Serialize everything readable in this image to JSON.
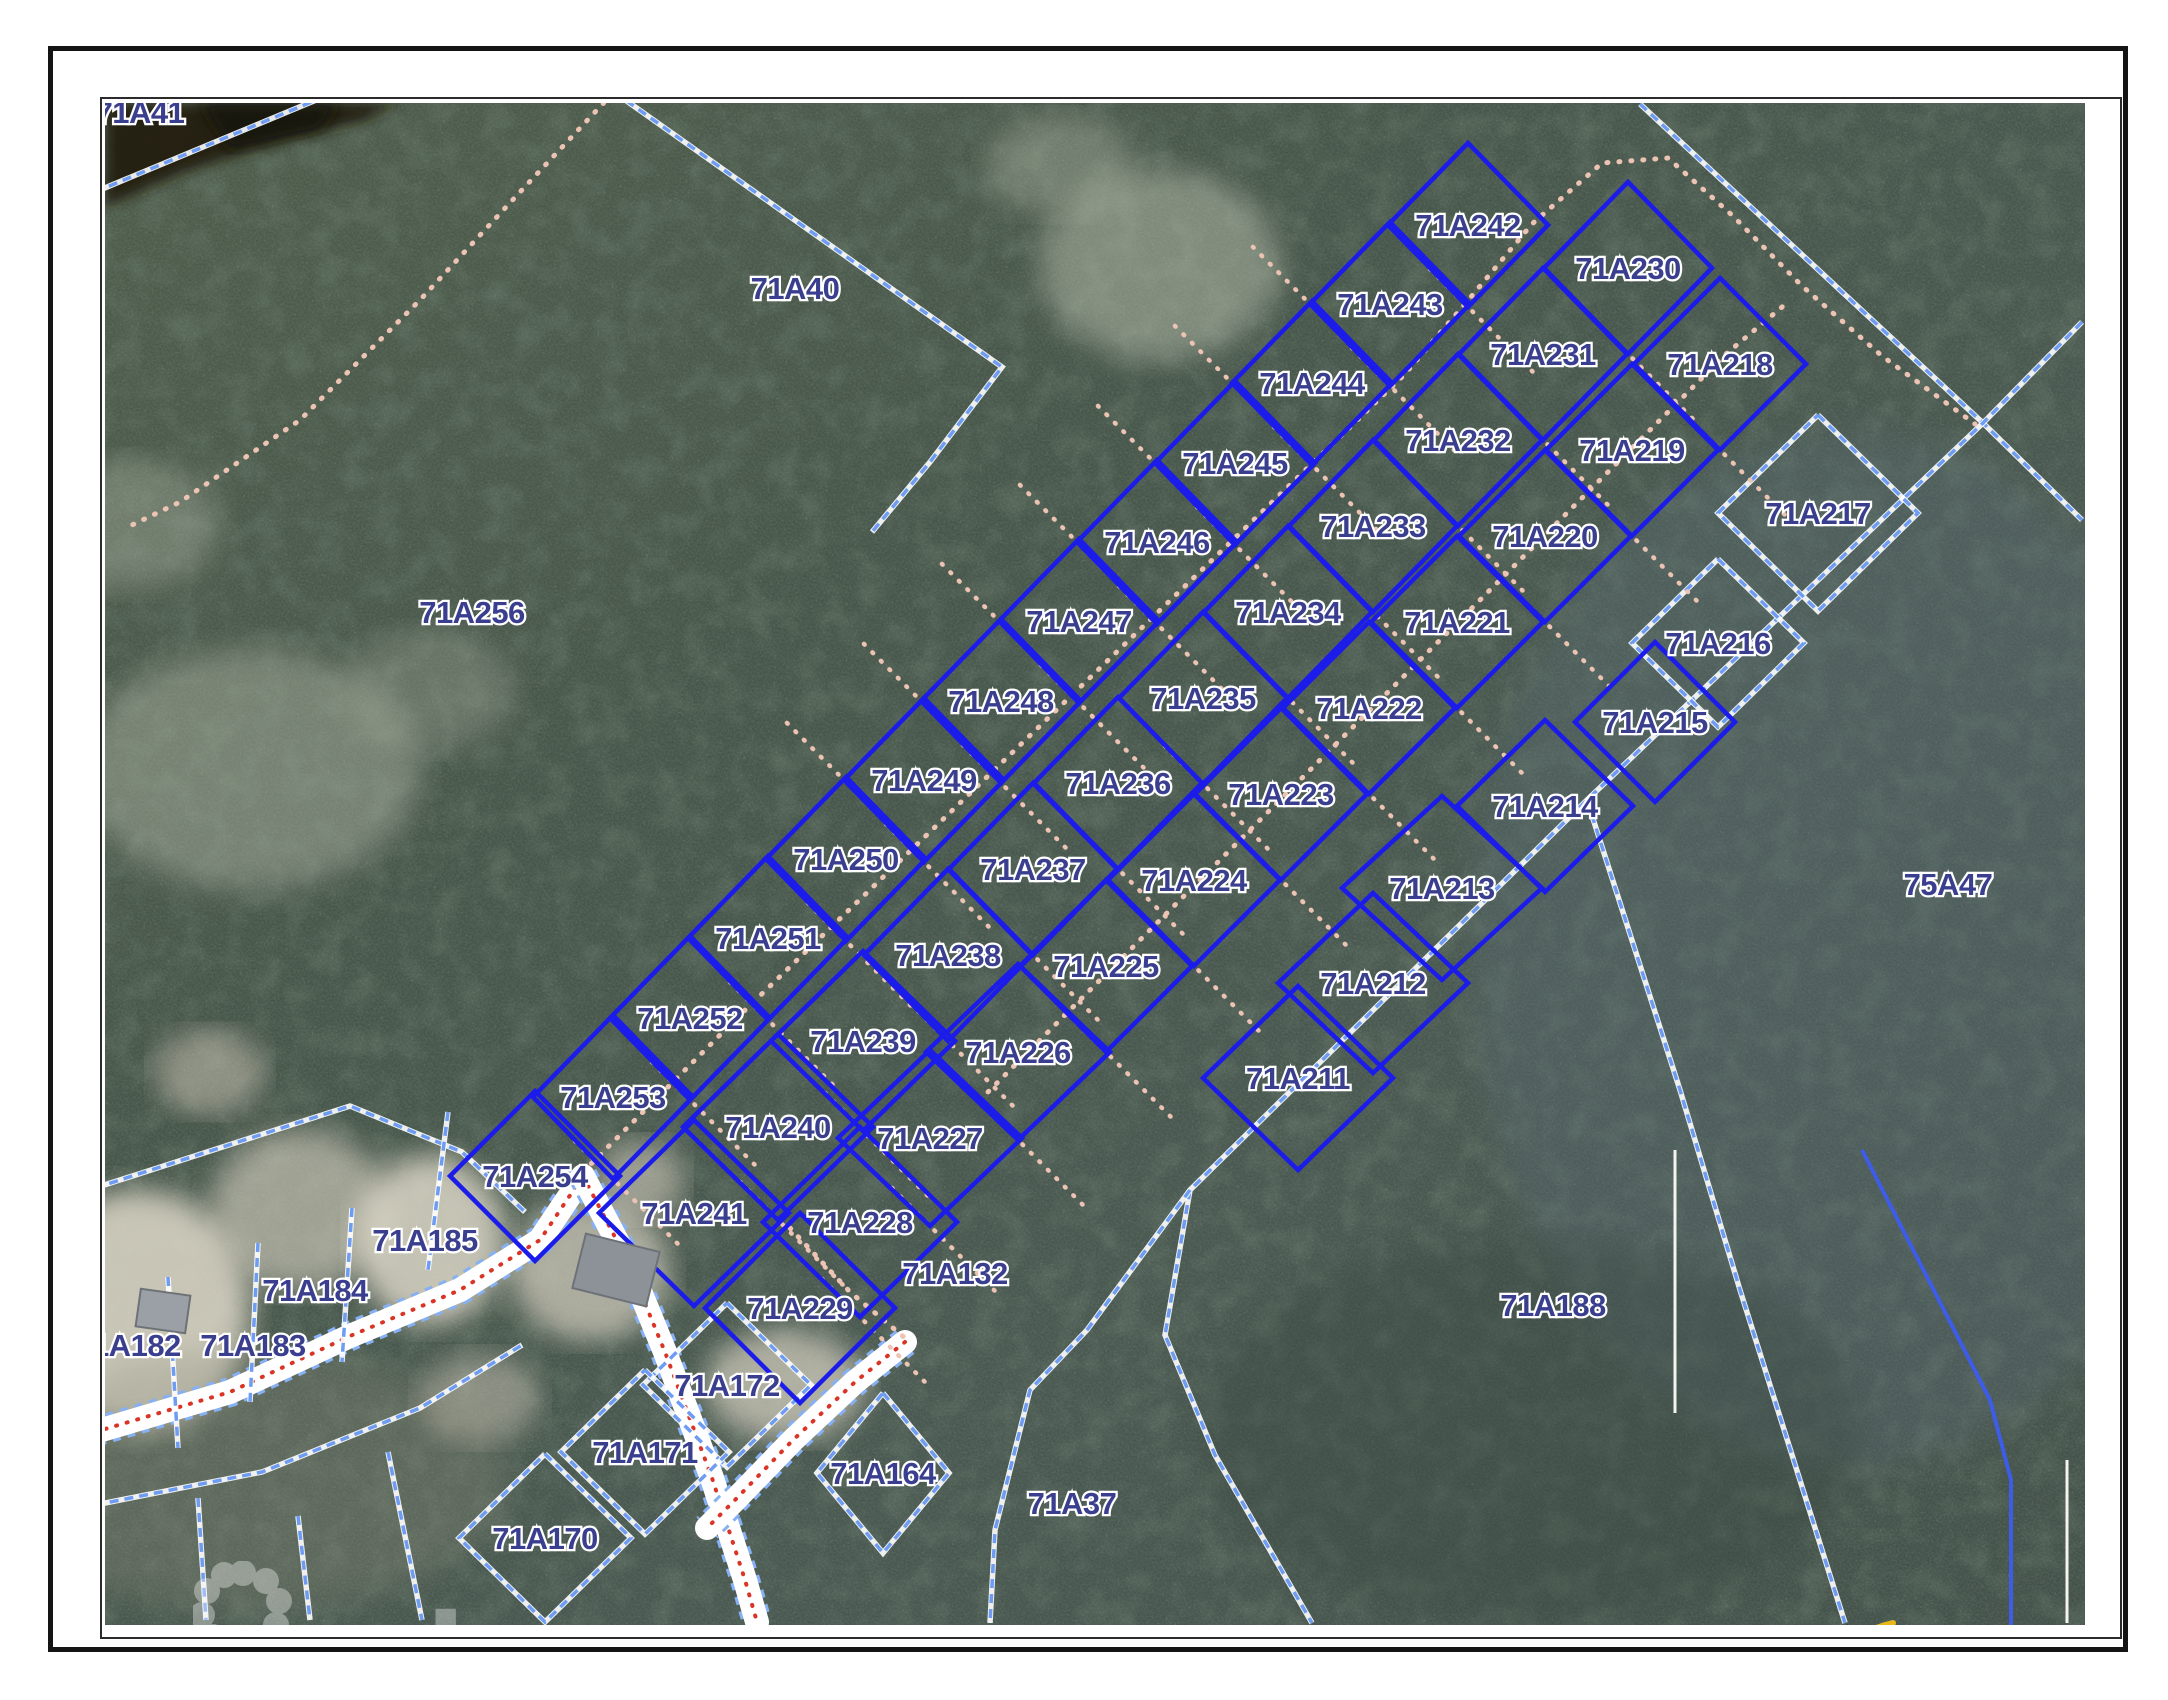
{
  "map": {
    "timestamp": "3/26/26 12:24 PM",
    "watermark_text": "ereba",
    "logo": {
      "title": "CAYMAN LAND INFO",
      "url": "www.caymanlandinfo.ky"
    },
    "colors": {
      "parcel_solid": "#1c1cea",
      "parcel_dashed": "#6d9cf2",
      "parcel_dashed_casing": "#ffffff",
      "boundary_solid_light": "#3d5cе8",
      "label_fill": "#3a3e8e",
      "label_halo": "#ffffff",
      "track_pink": "#edc4b4",
      "road_fill": "#ffffff",
      "road_center_red": "#d93425",
      "water_dark": "#241d10",
      "forest_base": "#49584a"
    },
    "solid_parcels": [
      {
        "id": "71A242",
        "x": 1468,
        "y": 225,
        "w": 80,
        "h": 82,
        "col": "A"
      },
      {
        "id": "71A243",
        "x": 1390,
        "y": 304,
        "w": 80,
        "h": 82,
        "col": "A"
      },
      {
        "id": "71A244",
        "x": 1312,
        "y": 383,
        "w": 80,
        "h": 82,
        "col": "A"
      },
      {
        "id": "71A245",
        "x": 1235,
        "y": 463,
        "w": 80,
        "h": 82,
        "col": "A"
      },
      {
        "id": "71A246",
        "x": 1157,
        "y": 542,
        "w": 80,
        "h": 82,
        "col": "A"
      },
      {
        "id": "71A247",
        "x": 1079,
        "y": 621,
        "w": 80,
        "h": 82,
        "col": "A"
      },
      {
        "id": "71A248",
        "x": 1001,
        "y": 701,
        "w": 80,
        "h": 82,
        "col": "A"
      },
      {
        "id": "71A249",
        "x": 924,
        "y": 780,
        "w": 80,
        "h": 82,
        "col": "A"
      },
      {
        "id": "71A250",
        "x": 846,
        "y": 859,
        "w": 80,
        "h": 82,
        "col": "A"
      },
      {
        "id": "71A251",
        "x": 768,
        "y": 938,
        "w": 80,
        "h": 82,
        "col": "A"
      },
      {
        "id": "71A252",
        "x": 690,
        "y": 1018,
        "w": 80,
        "h": 82,
        "col": "A"
      },
      {
        "id": "71A253",
        "x": 613,
        "y": 1097,
        "w": 80,
        "h": 82,
        "col": "A"
      },
      {
        "id": "71A254",
        "x": 535,
        "y": 1176,
        "w": 85,
        "h": 85,
        "col": "A"
      },
      {
        "id": "71A230",
        "x": 1628,
        "y": 268,
        "w": 84,
        "h": 86,
        "col": "B"
      },
      {
        "id": "71A231",
        "x": 1543,
        "y": 354,
        "w": 84,
        "h": 86,
        "col": "B"
      },
      {
        "id": "71A232",
        "x": 1458,
        "y": 440,
        "w": 84,
        "h": 86,
        "col": "B"
      },
      {
        "id": "71A233",
        "x": 1373,
        "y": 526,
        "w": 84,
        "h": 86,
        "col": "B"
      },
      {
        "id": "71A234",
        "x": 1288,
        "y": 612,
        "w": 84,
        "h": 86,
        "col": "B"
      },
      {
        "id": "71A235",
        "x": 1203,
        "y": 698,
        "w": 84,
        "h": 86,
        "col": "B"
      },
      {
        "id": "71A236",
        "x": 1118,
        "y": 783,
        "w": 84,
        "h": 86,
        "col": "B"
      },
      {
        "id": "71A237",
        "x": 1033,
        "y": 869,
        "w": 84,
        "h": 86,
        "col": "B"
      },
      {
        "id": "71A238",
        "x": 948,
        "y": 955,
        "w": 84,
        "h": 86,
        "col": "B"
      },
      {
        "id": "71A239",
        "x": 863,
        "y": 1041,
        "w": 92,
        "h": 90,
        "col": "B"
      },
      {
        "id": "71A240",
        "x": 778,
        "y": 1127,
        "w": 95,
        "h": 93,
        "col": "B"
      },
      {
        "id": "71A241",
        "x": 694,
        "y": 1213,
        "w": 95,
        "h": 93,
        "col": "B"
      },
      {
        "id": "71A218",
        "x": 1720,
        "y": 364,
        "w": 86,
        "h": 86,
        "col": "C"
      },
      {
        "id": "71A219",
        "x": 1632,
        "y": 450,
        "w": 86,
        "h": 86,
        "col": "C"
      },
      {
        "id": "71A220",
        "x": 1545,
        "y": 536,
        "w": 86,
        "h": 86,
        "col": "C"
      },
      {
        "id": "71A221",
        "x": 1457,
        "y": 622,
        "w": 86,
        "h": 86,
        "col": "C"
      },
      {
        "id": "71A222",
        "x": 1369,
        "y": 708,
        "w": 86,
        "h": 86,
        "col": "C"
      },
      {
        "id": "71A223",
        "x": 1281,
        "y": 794,
        "w": 86,
        "h": 86,
        "col": "C"
      },
      {
        "id": "71A224",
        "x": 1194,
        "y": 880,
        "w": 86,
        "h": 86,
        "col": "C"
      },
      {
        "id": "71A225",
        "x": 1106,
        "y": 966,
        "w": 86,
        "h": 86,
        "col": "C"
      },
      {
        "id": "71A226",
        "x": 1018,
        "y": 1052,
        "w": 92,
        "h": 88,
        "col": "C"
      },
      {
        "id": "71A227",
        "x": 930,
        "y": 1138,
        "w": 92,
        "h": 88,
        "col": "C"
      },
      {
        "id": "71A228",
        "x": 860,
        "y": 1222,
        "w": 97,
        "h": 95,
        "col": "C"
      },
      {
        "id": "71A229",
        "x": 800,
        "y": 1308,
        "w": 95,
        "h": 95,
        "col": "C"
      },
      {
        "id": "71A215",
        "x": 1655,
        "y": 722,
        "w": 80,
        "h": 80,
        "col": "D"
      },
      {
        "id": "71A214",
        "x": 1545,
        "y": 806,
        "w": 88,
        "h": 86,
        "col": "D"
      },
      {
        "id": "71A213",
        "x": 1442,
        "y": 888,
        "w": 100,
        "h": 92,
        "col": "D"
      },
      {
        "id": "71A212",
        "x": 1373,
        "y": 983,
        "w": 95,
        "h": 90,
        "col": "D"
      },
      {
        "id": "71A211",
        "x": 1298,
        "y": 1078,
        "w": 95,
        "h": 92,
        "col": "D"
      }
    ],
    "dashed_parcels": [
      {
        "id": "71A217",
        "x": 1818,
        "y": 513,
        "w": 100,
        "h": 98
      },
      {
        "id": "71A216",
        "x": 1718,
        "y": 643,
        "w": 86,
        "h": 84
      },
      {
        "id": "71A164",
        "x": 883,
        "y": 1473,
        "w": 66,
        "h": 80
      },
      {
        "id": "71A172",
        "x": 727,
        "y": 1385,
        "w": 84,
        "h": 82
      },
      {
        "id": "71A171",
        "x": 645,
        "y": 1452,
        "w": 84,
        "h": 82
      },
      {
        "id": "71A170",
        "x": 545,
        "y": 1538,
        "w": 86,
        "h": 84
      }
    ],
    "area_labels": [
      {
        "id": "71A41",
        "x": 140,
        "y": 112
      },
      {
        "id": "71A40",
        "x": 795,
        "y": 288
      },
      {
        "id": "71A256",
        "x": 472,
        "y": 612
      },
      {
        "id": "75A47",
        "x": 1948,
        "y": 884
      },
      {
        "id": "71A132",
        "x": 955,
        "y": 1273
      },
      {
        "id": "71A37",
        "x": 1072,
        "y": 1503
      },
      {
        "id": "71A188",
        "x": 1553,
        "y": 1305
      },
      {
        "id": "71A185",
        "x": 425,
        "y": 1240
      },
      {
        "id": "71A184",
        "x": 315,
        "y": 1290
      },
      {
        "id": "71A183",
        "x": 253,
        "y": 1345
      },
      {
        "id": "71A182",
        "x": 128,
        "y": 1345
      }
    ],
    "dashed_lines": [
      [
        [
          1640,
          104
        ],
        [
          1983,
          423
        ],
        [
          2082,
          520
        ]
      ],
      [
        [
          2082,
          322
        ],
        [
          1983,
          423
        ],
        [
          1587,
          800
        ],
        [
          1190,
          1190
        ],
        [
          1165,
          1335
        ],
        [
          1215,
          1455
        ],
        [
          1312,
          1623
        ]
      ],
      [
        [
          1587,
          800
        ],
        [
          1680,
          1090
        ],
        [
          1740,
          1290
        ],
        [
          1845,
          1623
        ]
      ],
      [
        [
          1190,
          1190
        ],
        [
          1087,
          1330
        ],
        [
          1030,
          1390
        ],
        [
          995,
          1530
        ],
        [
          990,
          1623
        ]
      ],
      [
        [
          95,
          1188
        ],
        [
          350,
          1106
        ],
        [
          462,
          1152
        ],
        [
          525,
          1212
        ]
      ],
      [
        [
          168,
          1277
        ],
        [
          178,
          1448
        ]
      ],
      [
        [
          258,
          1243
        ],
        [
          250,
          1402
        ]
      ],
      [
        [
          352,
          1208
        ],
        [
          342,
          1362
        ]
      ],
      [
        [
          448,
          1112
        ],
        [
          428,
          1270
        ]
      ],
      [
        [
          88,
          1488
        ],
        [
          92,
          1620
        ]
      ],
      [
        [
          198,
          1498
        ],
        [
          206,
          1620
        ]
      ],
      [
        [
          298,
          1516
        ],
        [
          310,
          1620
        ]
      ],
      [
        [
          388,
          1452
        ],
        [
          422,
          1620
        ]
      ],
      [
        [
          95,
          1505
        ],
        [
          262,
          1472
        ],
        [
          420,
          1408
        ],
        [
          522,
          1345
        ]
      ],
      [
        [
          95,
          192
        ],
        [
          345,
          88
        ],
        [
          614,
          92
        ]
      ],
      [
        [
          614,
          92
        ],
        [
          1002,
          367
        ],
        [
          930,
          462
        ],
        [
          872,
          532
        ]
      ]
    ],
    "solid_light_lines": [
      [
        [
          1862,
          1150
        ],
        [
          1990,
          1400
        ],
        [
          2011,
          1480
        ],
        [
          2011,
          1625
        ]
      ]
    ],
    "white_lines": [
      [
        [
          1675,
          1150
        ],
        [
          1675,
          1413
        ]
      ],
      [
        [
          2067,
          1460
        ],
        [
          2067,
          1623
        ]
      ]
    ],
    "pink_tracks": [
      [
        [
          583,
          1172
        ],
        [
          660,
          1095
        ],
        [
          740,
          1015
        ],
        [
          823,
          935
        ],
        [
          906,
          855
        ],
        [
          989,
          775
        ],
        [
          1072,
          695
        ],
        [
          1155,
          615
        ],
        [
          1238,
          535
        ],
        [
          1321,
          455
        ],
        [
          1404,
          375
        ],
        [
          1470,
          298
        ],
        [
          1532,
          224
        ],
        [
          1602,
          163
        ],
        [
          1668,
          158
        ],
        [
          1733,
          216
        ],
        [
          1802,
          286
        ],
        [
          1882,
          356
        ],
        [
          1975,
          424
        ]
      ],
      [
        [
          988,
          1092
        ],
        [
          1070,
          1010
        ],
        [
          1152,
          928
        ],
        [
          1234,
          846
        ],
        [
          1316,
          764
        ],
        [
          1398,
          682
        ],
        [
          1480,
          600
        ],
        [
          1562,
          518
        ],
        [
          1644,
          436
        ],
        [
          1726,
          354
        ],
        [
          1788,
          302
        ]
      ],
      [
        [
          790,
          1228
        ],
        [
          850,
          1292
        ],
        [
          905,
          1338
        ]
      ],
      [
        [
          612,
          94
        ],
        [
          520,
          192
        ],
        [
          420,
          300
        ],
        [
          300,
          420
        ],
        [
          180,
          502
        ],
        [
          132,
          525
        ]
      ]
    ],
    "roads": [
      [
        [
          95,
          1432
        ],
        [
          230,
          1392
        ],
        [
          350,
          1336
        ],
        [
          460,
          1290
        ],
        [
          540,
          1240
        ],
        [
          583,
          1176
        ]
      ],
      [
        [
          583,
          1176
        ],
        [
          628,
          1262
        ],
        [
          665,
          1352
        ],
        [
          712,
          1478
        ],
        [
          745,
          1580
        ],
        [
          757,
          1622
        ]
      ],
      [
        [
          905,
          1342
        ],
        [
          855,
          1382
        ],
        [
          793,
          1440
        ],
        [
          735,
          1500
        ],
        [
          707,
          1528
        ]
      ]
    ],
    "water_patches": [
      {
        "pts": [
          [
            105,
            103
          ],
          [
            400,
            103
          ],
          [
            360,
            122
          ],
          [
            280,
            142
          ],
          [
            190,
            170
          ],
          [
            105,
            207
          ]
        ],
        "fill": "#241d10",
        "op": 0.92
      },
      {
        "pts": [
          [
            200,
            103
          ],
          [
            340,
            103
          ],
          [
            320,
            130
          ],
          [
            230,
            150
          ]
        ],
        "fill": "#191307",
        "op": 0.85
      }
    ],
    "sand_patches": [
      {
        "cx": 140,
        "cy": 1310,
        "rx": 110,
        "ry": 120,
        "fill": "#ded8c8",
        "op": 0.85
      },
      {
        "cx": 300,
        "cy": 1210,
        "rx": 90,
        "ry": 80,
        "fill": "#d8d2c2",
        "op": 0.6
      },
      {
        "cx": 430,
        "cy": 1240,
        "rx": 75,
        "ry": 85,
        "fill": "#e2dccc",
        "op": 0.8
      },
      {
        "cx": 590,
        "cy": 1270,
        "rx": 80,
        "ry": 70,
        "fill": "#d5cfc0",
        "op": 0.7
      },
      {
        "cx": 640,
        "cy": 1180,
        "rx": 45,
        "ry": 40,
        "fill": "#cfc9ba",
        "op": 0.6
      },
      {
        "cx": 785,
        "cy": 1385,
        "rx": 80,
        "ry": 55,
        "fill": "#d8d2c2",
        "op": 0.7
      },
      {
        "cx": 480,
        "cy": 1398,
        "rx": 60,
        "ry": 45,
        "fill": "#cac4b5",
        "op": 0.5
      },
      {
        "cx": 250,
        "cy": 770,
        "rx": 170,
        "ry": 120,
        "fill": "#b9c0ae",
        "op": 0.4
      },
      {
        "cx": 130,
        "cy": 525,
        "rx": 90,
        "ry": 65,
        "fill": "#b4bbaa",
        "op": 0.35
      },
      {
        "cx": 430,
        "cy": 690,
        "rx": 85,
        "ry": 60,
        "fill": "#aeb5a4",
        "op": 0.3
      },
      {
        "cx": 1160,
        "cy": 265,
        "rx": 120,
        "ry": 95,
        "fill": "#c2c9b6",
        "op": 0.45
      },
      {
        "cx": 1060,
        "cy": 165,
        "rx": 75,
        "ry": 50,
        "fill": "#bcc3b0",
        "op": 0.35
      },
      {
        "cx": 210,
        "cy": 1072,
        "rx": 55,
        "ry": 42,
        "fill": "#c6c0b0",
        "op": 0.55
      },
      {
        "cx": 1850,
        "cy": 950,
        "rx": 380,
        "ry": 520,
        "fill": "#5d6e78",
        "op": 0.3
      },
      {
        "cx": 1530,
        "cy": 1430,
        "rx": 330,
        "ry": 190,
        "fill": "#39463f",
        "op": 0.35
      },
      {
        "cx": 250,
        "cy": 1480,
        "rx": 260,
        "ry": 130,
        "fill": "#8e8f7e",
        "op": 0.3
      }
    ],
    "buildings": [
      {
        "x": 578,
        "y": 1242,
        "w": 76,
        "h": 56,
        "rot": 14,
        "fill": "#8d9299"
      },
      {
        "x": 138,
        "y": 1292,
        "w": 50,
        "h": 38,
        "rot": 8,
        "fill": "#9aa0a5"
      }
    ]
  }
}
